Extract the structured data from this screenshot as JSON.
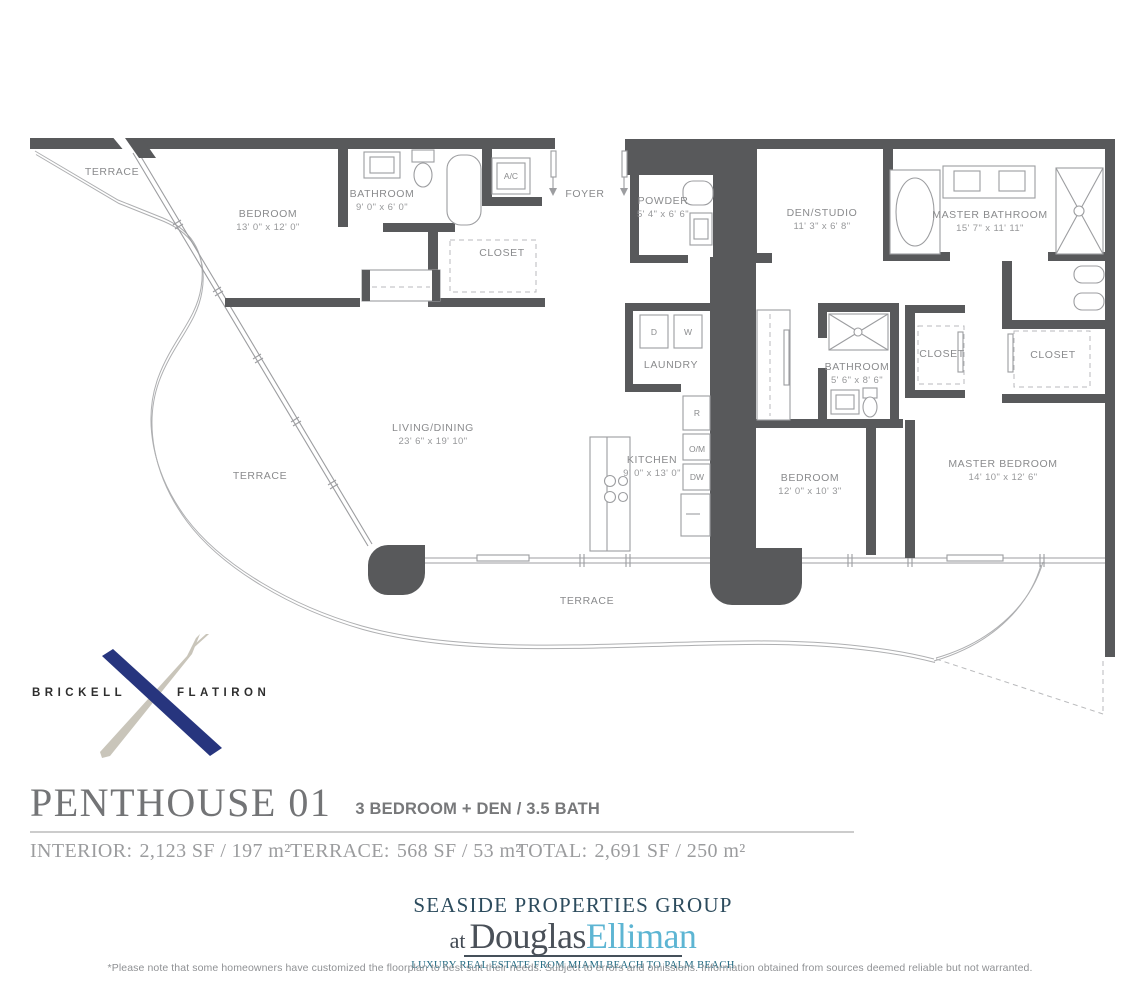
{
  "plan": {
    "rooms": [
      {
        "name": "TERRACE"
      },
      {
        "name": "BEDROOM",
        "dims": "13' 0\" x 12' 0\""
      },
      {
        "name": "BATHROOM",
        "dims": "9' 0\" x 6' 0\""
      },
      {
        "name": "FOYER"
      },
      {
        "name": "POWDER",
        "dims": "5' 4\" x 6' 6\""
      },
      {
        "name": "DEN/STUDIO",
        "dims": "11' 3\" x 6' 8\""
      },
      {
        "name": "MASTER BATHROOM",
        "dims": "15' 7\" x 11' 11\""
      },
      {
        "name": "CLOSET"
      },
      {
        "name": "LAUNDRY"
      },
      {
        "name": "BATHROOM",
        "dims": "5' 6\" x 8' 6\""
      },
      {
        "name": "CLOSET"
      },
      {
        "name": "CLOSET"
      },
      {
        "name": "LIVING/DINING",
        "dims": "23' 6\" x 19' 10\""
      },
      {
        "name": "KITCHEN",
        "dims": "9' 0\" x 13' 0\""
      },
      {
        "name": "BEDROOM",
        "dims": "12' 0\" x 10' 3\""
      },
      {
        "name": "MASTER BEDROOM",
        "dims": "14' 10\" x 12' 6\""
      },
      {
        "name": "TERRACE"
      },
      {
        "name": "TERRACE"
      }
    ],
    "appliances": {
      "d": "D",
      "w": "W",
      "r": "R",
      "om": "O/M",
      "dw": "DW",
      "ac": "A/C"
    }
  },
  "logo": {
    "left": "BRICKELL",
    "right": "FLATIRON",
    "x_blue": "#27357e",
    "x_silver": "#c9c5ba"
  },
  "title": {
    "name": "PENTHOUSE 01",
    "subtitle": "3 BEDROOM + DEN / 3.5 BATH"
  },
  "stats": {
    "interior_label": "INTERIOR:",
    "interior_value": "2,123 SF / 197 m²",
    "terrace_label": "TERRACE:",
    "terrace_value": "568 SF / 53 m²",
    "total_label": "TOTAL:",
    "total_value": "2,691 SF / 250 m²"
  },
  "branding": {
    "group": "SEASIDE PROPERTIES GROUP",
    "at": "at",
    "name_dark": "Douglas",
    "name_light": "Elliman",
    "tagline": "LUXURY REAL ESTATE FROM MIAMI BEACH TO PALM BEACH",
    "accent_dark": "#2c4b5d",
    "accent_light": "#5db5d3"
  },
  "disclaimer": "*Please note that some homeowners have customized the floorplan to best suit their needs. Subject to errors and omissions. Information obtained from sources deemed reliable but not warranted.",
  "colors": {
    "wall": "#58595b",
    "line": "#9c9da0",
    "label": "#8a8b8d"
  }
}
